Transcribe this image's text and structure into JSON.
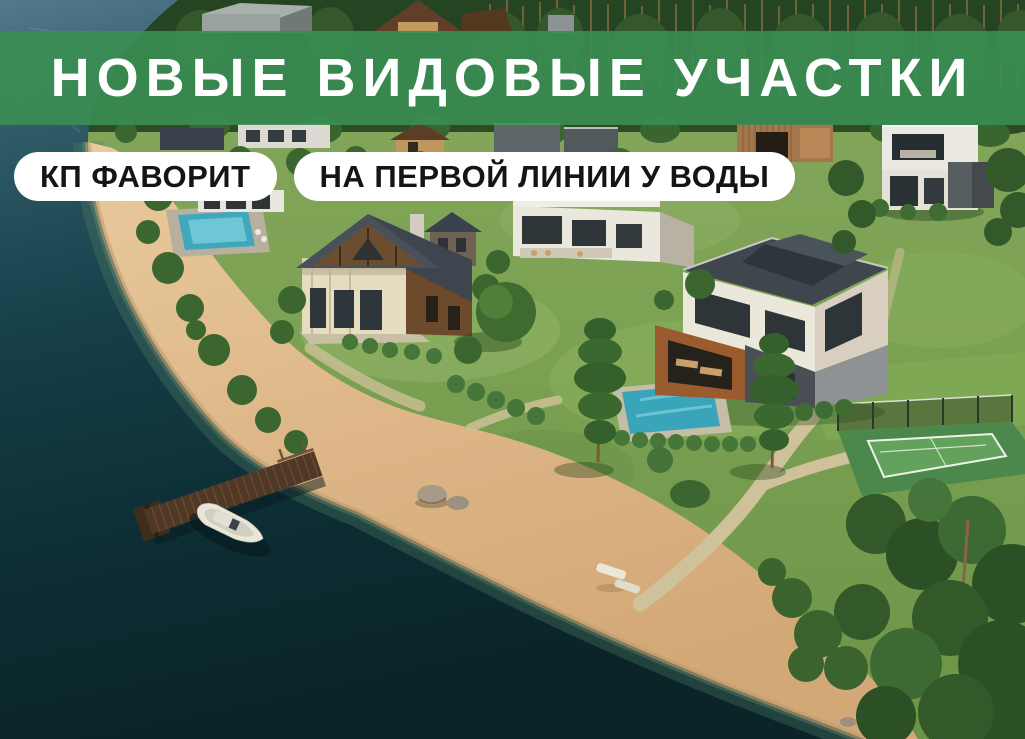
{
  "banner": {
    "title": "НОВЫЕ ВИДОВЫЕ УЧАСТКИ",
    "background_color": "#3a8e52",
    "text_color": "#ffffff"
  },
  "badges": [
    {
      "label": "КП ФАВОРИТ",
      "background_color": "#ffffff",
      "text_color": "#151515"
    },
    {
      "label": "НА ПЕРВОЙ ЛИНИИ У ВОДЫ",
      "background_color": "#ffffff",
      "text_color": "#151515"
    }
  ],
  "scene": {
    "type": "aerial-photo",
    "elements": [
      "lake",
      "sandy-beach",
      "wooden-pier",
      "motor-boat",
      "rocks",
      "pine-forest",
      "chalet-house",
      "modern-villa",
      "cube-house",
      "pool-house",
      "swimming-pool",
      "tennis-court",
      "gravel-paths",
      "trees-and-hedges"
    ],
    "palette": {
      "water_deep": "#0b2529",
      "water_light": "#53798c",
      "sand": "#ddb98a",
      "wet_sand": "#c09a6e",
      "grass": "#7aa152",
      "forest": "#2c4c28",
      "pool_water": "#3fa8bd",
      "tennis_court": "#5fa058",
      "pier_wood": "#503826",
      "boat_hull": "#e9e6da"
    }
  }
}
